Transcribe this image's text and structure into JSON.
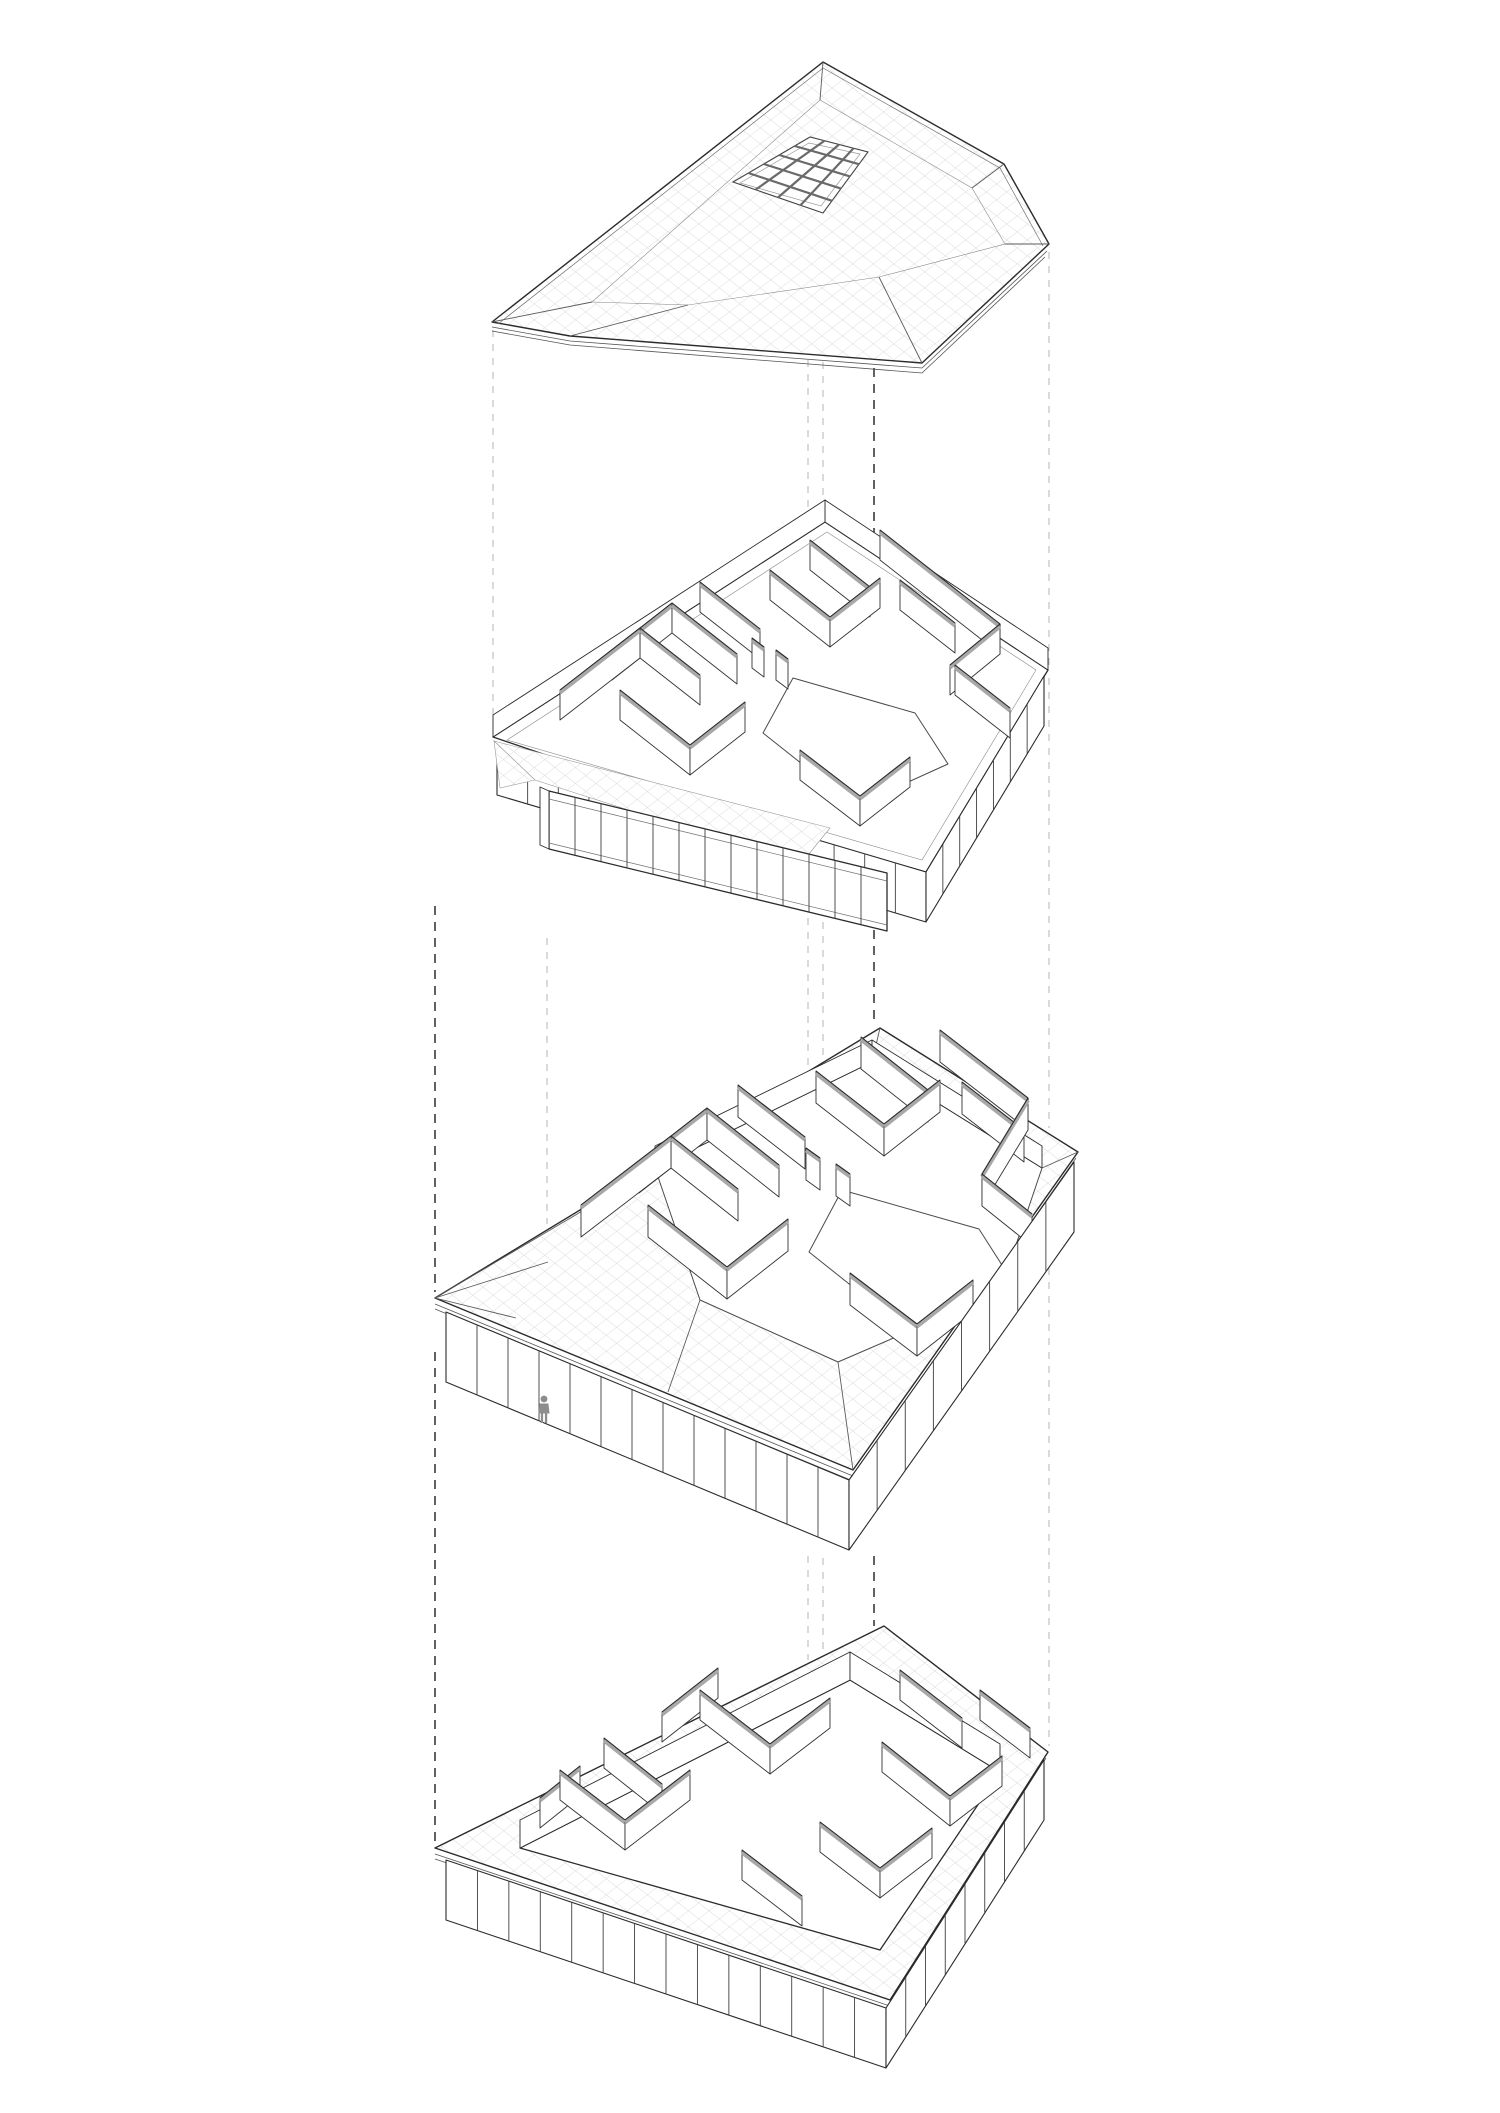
{
  "figure": {
    "kind": "exploded-axonometric-building-diagram",
    "levels": [
      "roof",
      "upper-floor",
      "main-level",
      "lower-floor"
    ],
    "level_count": 4
  },
  "palette": {
    "background": "#ffffff",
    "line_dark": "#2b2b2b",
    "line_mid": "#555555",
    "grid_light": "#cccccc",
    "wall_cap_gray": "#a8a8a8",
    "mullion": "#3f3f3f",
    "dash_light": "#b4b4b4",
    "dash_dark": "#3a3a3a",
    "person_gray": "#8d8d8d"
  },
  "icons": {
    "person": "person-silhouette-icon"
  },
  "guides": [
    {
      "x": 493,
      "dark": false,
      "segs": [
        [
          330,
          733
        ]
      ]
    },
    {
      "x": 547,
      "dark": false,
      "segs": [
        [
          938,
          1224
        ]
      ]
    },
    {
      "x": 808,
      "dark": false,
      "segs": [
        [
          360,
          531
        ],
        [
          848,
          1066
        ],
        [
          1556,
          1660
        ]
      ]
    },
    {
      "x": 823,
      "dark": false,
      "segs": [
        [
          362,
          540
        ],
        [
          852,
          1058
        ],
        [
          1558,
          1654
        ]
      ]
    },
    {
      "x": 874,
      "dark": true,
      "segs": [
        [
          368,
          551
        ],
        [
          866,
          1026
        ],
        [
          1556,
          1626
        ]
      ]
    },
    {
      "x": 1049,
      "dark": false,
      "segs": [
        [
          252,
          665
        ],
        [
          678,
          1128
        ],
        [
          1240,
          1746
        ]
      ]
    },
    {
      "x": 435,
      "dark": true,
      "segs": [
        [
          906,
          1292
        ],
        [
          1352,
          1842
        ]
      ]
    }
  ],
  "skylight": {
    "quad": [
      [
        733,
        182
      ],
      [
        810,
        137
      ],
      [
        868,
        152
      ],
      [
        823,
        213
      ]
    ],
    "rows": 4,
    "cols": 5
  },
  "upper_floor": {
    "wall_height": 30,
    "walls": [
      [
        810,
        570,
        870,
        617
      ],
      [
        880,
        560,
        1000,
        654
      ],
      [
        770,
        600,
        830,
        647
      ],
      [
        830,
        647,
        880,
        608
      ],
      [
        900,
        610,
        955,
        653
      ],
      [
        700,
        612,
        760,
        659
      ],
      [
        612,
        680,
        672,
        633
      ],
      [
        672,
        633,
        737,
        684
      ],
      [
        1000,
        654,
        950,
        695
      ],
      [
        640,
        658,
        700,
        705
      ],
      [
        560,
        720,
        640,
        658
      ],
      [
        955,
        695,
        1010,
        738
      ],
      [
        752,
        668,
        764,
        677
      ],
      [
        776,
        680,
        788,
        689
      ],
      [
        620,
        720,
        690,
        775
      ],
      [
        690,
        775,
        745,
        732
      ],
      [
        800,
        780,
        860,
        826
      ],
      [
        860,
        826,
        910,
        787
      ]
    ],
    "bands": [
      {
        "quad": [
          [
            497,
            745
          ],
          [
            926,
            872
          ],
          [
            926,
            922
          ],
          [
            497,
            795
          ]
        ],
        "n": 14
      },
      {
        "quad": [
          [
            926,
            872
          ],
          [
            1044,
            676
          ],
          [
            1044,
            726
          ],
          [
            926,
            922
          ]
        ],
        "n": 7
      }
    ],
    "walkway_posts": {
      "quad": [
        [
          549,
          791
        ],
        [
          887,
          873
        ],
        [
          887,
          931
        ],
        [
          549,
          849
        ]
      ],
      "n": 13,
      "nofill": true
    }
  },
  "main_level": {
    "wall_height": 32,
    "walls": [
      [
        861,
        1069,
        928,
        1122
      ],
      [
        940,
        1062,
        1028,
        1130
      ],
      [
        816,
        1103,
        884,
        1156
      ],
      [
        884,
        1156,
        940,
        1112
      ],
      [
        962,
        1114,
        1024,
        1162
      ],
      [
        738,
        1117,
        805,
        1169
      ],
      [
        639,
        1193,
        707,
        1140
      ],
      [
        707,
        1140,
        779,
        1197
      ],
      [
        1028,
        1130,
        982,
        1206
      ],
      [
        671,
        1168,
        738,
        1221
      ],
      [
        581,
        1237,
        671,
        1168
      ],
      [
        982,
        1206,
        1032,
        1246
      ],
      [
        806,
        1180,
        820,
        1190
      ],
      [
        836,
        1196,
        850,
        1206
      ],
      [
        648,
        1237,
        727,
        1299
      ],
      [
        727,
        1299,
        788,
        1251
      ],
      [
        850,
        1305,
        917,
        1356
      ],
      [
        917,
        1356,
        973,
        1312
      ]
    ],
    "bands": [
      {
        "quad": [
          [
            446,
            1312
          ],
          [
            849,
            1480
          ],
          [
            849,
            1550
          ],
          [
            446,
            1382
          ]
        ],
        "n": 13
      },
      {
        "quad": [
          [
            849,
            1480
          ],
          [
            1074,
            1162
          ],
          [
            1074,
            1232
          ],
          [
            849,
            1550
          ]
        ],
        "n": 8
      }
    ],
    "person": {
      "x": 544,
      "y": 1423
    }
  },
  "lower_floor": {
    "wall_height": 30,
    "walls": [
      [
        662,
        1742,
        718,
        1698
      ],
      [
        900,
        1700,
        962,
        1748
      ],
      [
        700,
        1720,
        770,
        1774
      ],
      [
        980,
        1720,
        1030,
        1758
      ],
      [
        604,
        1768,
        662,
        1814
      ],
      [
        770,
        1774,
        830,
        1728
      ],
      [
        882,
        1772,
        950,
        1826
      ],
      [
        540,
        1828,
        580,
        1796
      ],
      [
        950,
        1826,
        1002,
        1786
      ],
      [
        560,
        1800,
        625,
        1850
      ],
      [
        625,
        1850,
        690,
        1800
      ],
      [
        820,
        1852,
        880,
        1898
      ],
      [
        880,
        1898,
        932,
        1858
      ],
      [
        742,
        1880,
        802,
        1926
      ]
    ],
    "bands": [
      {
        "quad": [
          [
            446,
            1860
          ],
          [
            886,
            2008
          ],
          [
            886,
            2068
          ],
          [
            446,
            1920
          ]
        ],
        "n": 14
      },
      {
        "quad": [
          [
            886,
            2008
          ],
          [
            1044,
            1760
          ],
          [
            1044,
            1820
          ],
          [
            886,
            2068
          ]
        ],
        "n": 8
      }
    ]
  }
}
